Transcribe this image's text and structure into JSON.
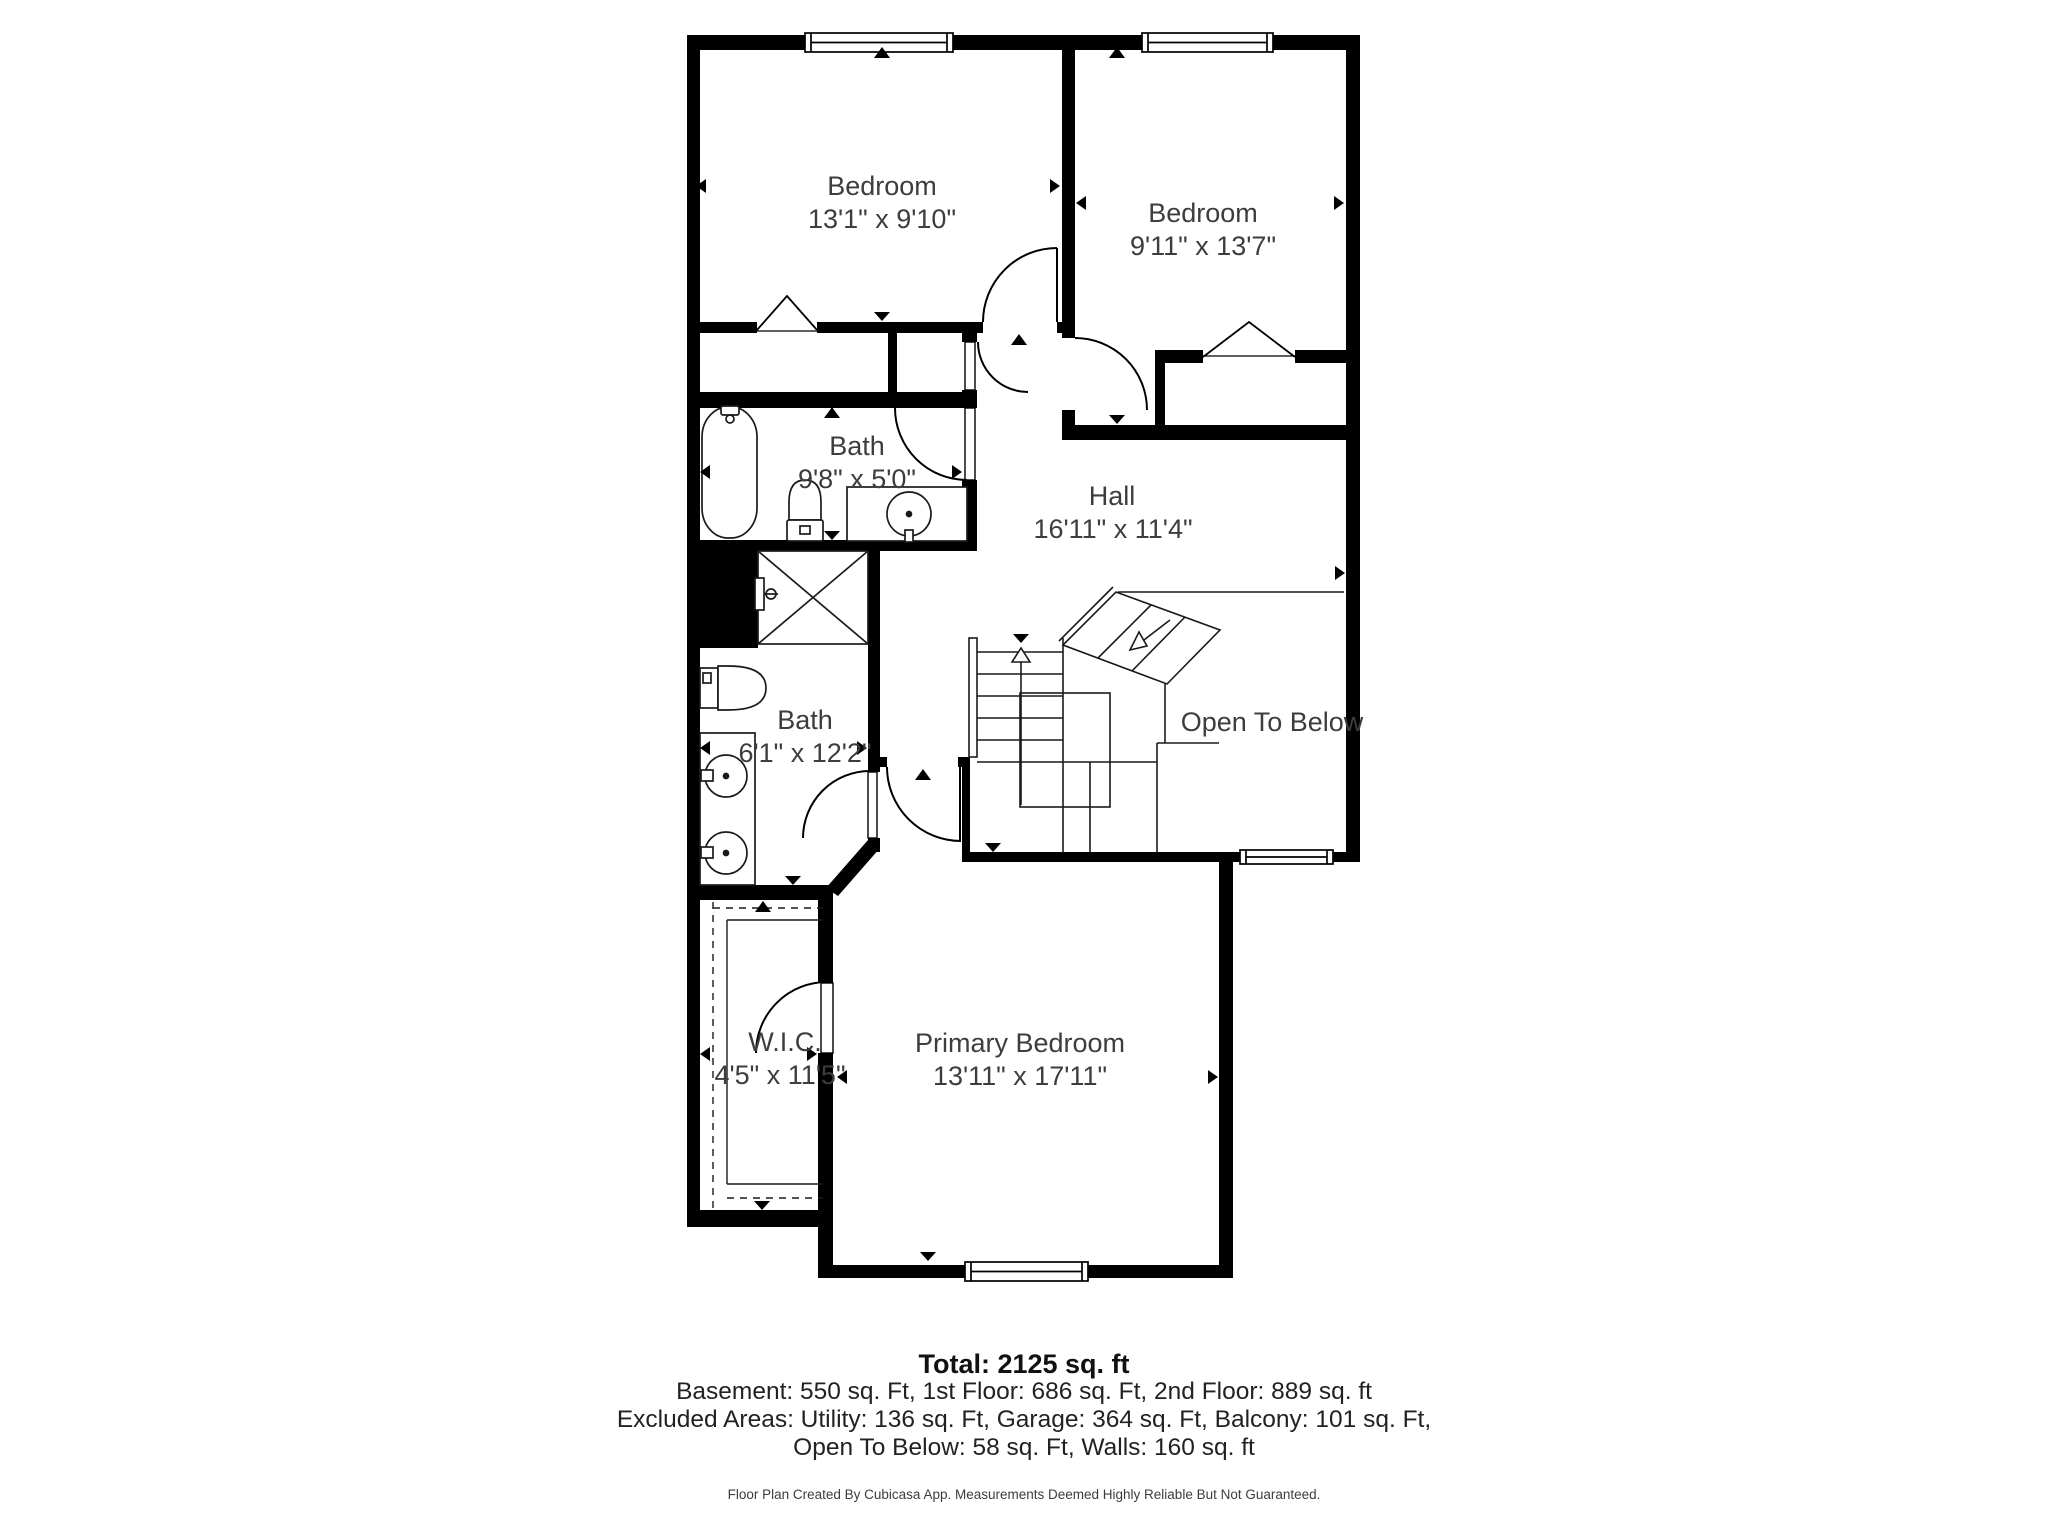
{
  "floor_plan": {
    "wall_color": "#000000",
    "label_color": "#3d3d3d",
    "rooms": [
      {
        "id": "bedroom-left",
        "name": "Bedroom",
        "dims": "13'1\" x 9'10\""
      },
      {
        "id": "bedroom-right",
        "name": "Bedroom",
        "dims": "9'11\" x 13'7\""
      },
      {
        "id": "bath-upper",
        "name": "Bath",
        "dims": "9'8\" x 5'0\""
      },
      {
        "id": "hall",
        "name": "Hall",
        "dims": "16'11\" x 11'4\""
      },
      {
        "id": "bath-lower",
        "name": "Bath",
        "dims": "6'1\" x 12'2\""
      },
      {
        "id": "open-to-below",
        "name": "Open To Below",
        "dims": ""
      },
      {
        "id": "wic",
        "name": "W.I.C.",
        "dims": "4'5\" x 11'5\""
      },
      {
        "id": "primary-bedroom",
        "name": "Primary Bedroom",
        "dims": "13'11\" x 17'11\""
      }
    ]
  },
  "summary": {
    "total": "Total: 2125 sq. ft",
    "floors_line": "Basement: 550 sq. Ft, 1st Floor: 686 sq. Ft, 2nd Floor: 889 sq. ft",
    "excluded_line1": "Excluded Areas: Utility: 136 sq. Ft, Garage: 364 sq. Ft, Balcony: 101 sq. Ft,",
    "excluded_line2": "Open To Below: 58 sq. Ft, Walls: 160 sq. ft"
  },
  "footer_note": "Floor Plan Created By Cubicasa App. Measurements Deemed Highly Reliable But Not Guaranteed."
}
